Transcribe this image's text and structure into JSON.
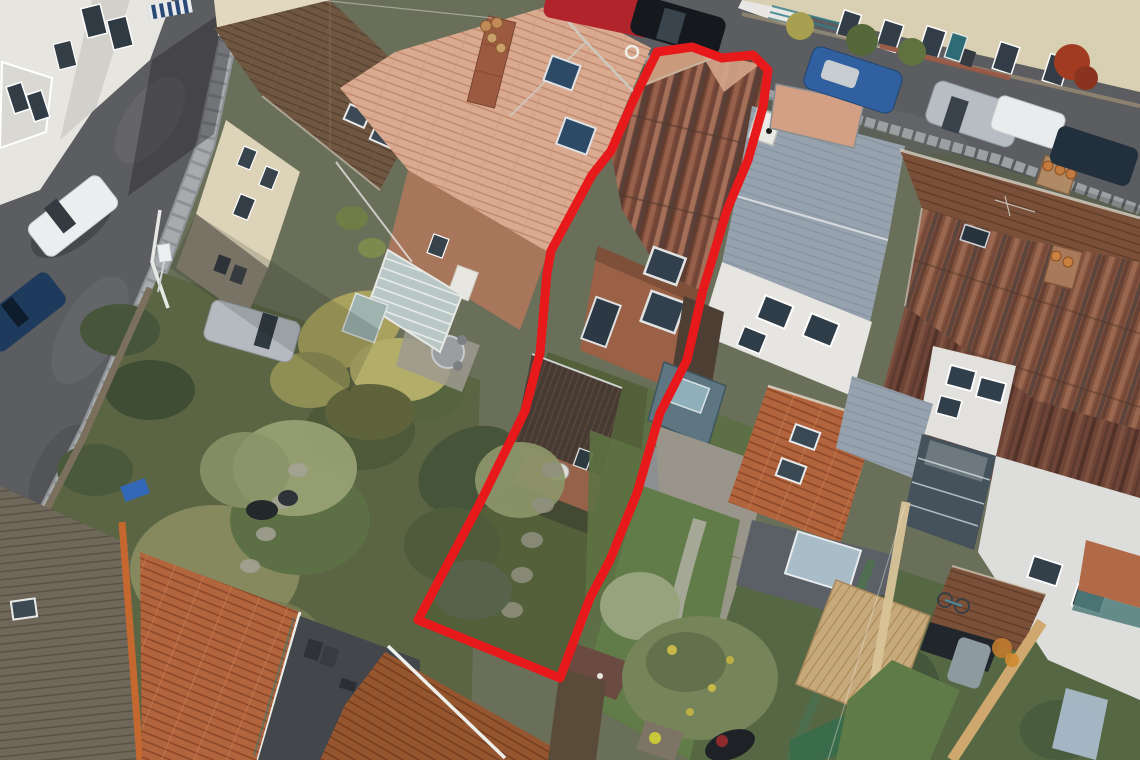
{
  "scene": {
    "type": "aerial-drone-photograph",
    "description": "Overhead view of a UK terraced street block: rooftops, two streets with parked cars, and long rear gardens. A red outline highlights one mid-terrace property and its narrow rear garden.",
    "visible_text": []
  },
  "boundary": {
    "label": "highlighted-property-boundary",
    "color": "#e7191b",
    "stroke_width": 9,
    "points": [
      [
        657,
        52
      ],
      [
        692,
        47
      ],
      [
        722,
        58
      ],
      [
        753,
        55
      ],
      [
        768,
        70
      ],
      [
        763,
        107
      ],
      [
        748,
        160
      ],
      [
        727,
        210
      ],
      [
        703,
        290
      ],
      [
        687,
        360
      ],
      [
        660,
        413
      ],
      [
        637,
        493
      ],
      [
        610,
        560
      ],
      [
        590,
        598
      ],
      [
        560,
        678
      ],
      [
        418,
        620
      ],
      [
        480,
        503
      ],
      [
        525,
        411
      ],
      [
        540,
        353
      ],
      [
        547,
        273
      ],
      [
        551,
        251
      ],
      [
        592,
        175
      ],
      [
        611,
        151
      ],
      [
        633,
        101
      ]
    ],
    "marker": {
      "cx": 632,
      "cy": 52,
      "r": 6,
      "color": "#edefe9"
    }
  },
  "palette": {
    "asphalt": "#5c5d60",
    "sidewalk": "#a8abae",
    "scrub": "#5b6543",
    "left_lawn": "#5d6f44",
    "subject_garden": "#53603a",
    "right_garden": "#5d6f45",
    "far_gardens": "#566743",
    "cream_house": "#d9cfb2",
    "white_wall": "#e6e5e1",
    "brick_wall": "#9a6146",
    "slate_roof": "#96a2ad",
    "salmon_roof": "#d9aa8f",
    "weathered_roof": "#7c4a38",
    "bright_red_roof": "#b2643c",
    "deck_timber": "#c7aa7c",
    "glass_teal": "#5d7682"
  },
  "objects": {
    "cars": [
      {
        "name": "white-hatchback-left-street",
        "color": "#ebeeee"
      },
      {
        "name": "dark-blue-car-left-street",
        "color": "#1e3a5c"
      },
      {
        "name": "silver-car-driveway",
        "color": "#b4babf"
      },
      {
        "name": "red-car-top-street",
        "color": "#b2242c"
      },
      {
        "name": "black-coupe-top-street",
        "color": "#15181d"
      },
      {
        "name": "blue-suv-top-street",
        "color": "#30609f"
      },
      {
        "name": "silver-hatchback-top-street",
        "color": "#b7bdc2"
      },
      {
        "name": "white-van-top-street",
        "color": "#e9ebec"
      },
      {
        "name": "dark-car-top-street-right",
        "color": "#222f3c"
      }
    ],
    "landmarks": [
      "subject-weathered-tile-roof",
      "subject-rear-brick-elevation",
      "subject-rear-extension",
      "subject-long-garden",
      "neighbour-salmon-roof-with-chimney",
      "neighbour-slate-roof",
      "modern-glass-extension",
      "orange-gable-roof",
      "bottom-left-outbuilding-roofs",
      "round-patio-table",
      "pergola-vines",
      "timber-decking",
      "new-timber-fence"
    ]
  }
}
